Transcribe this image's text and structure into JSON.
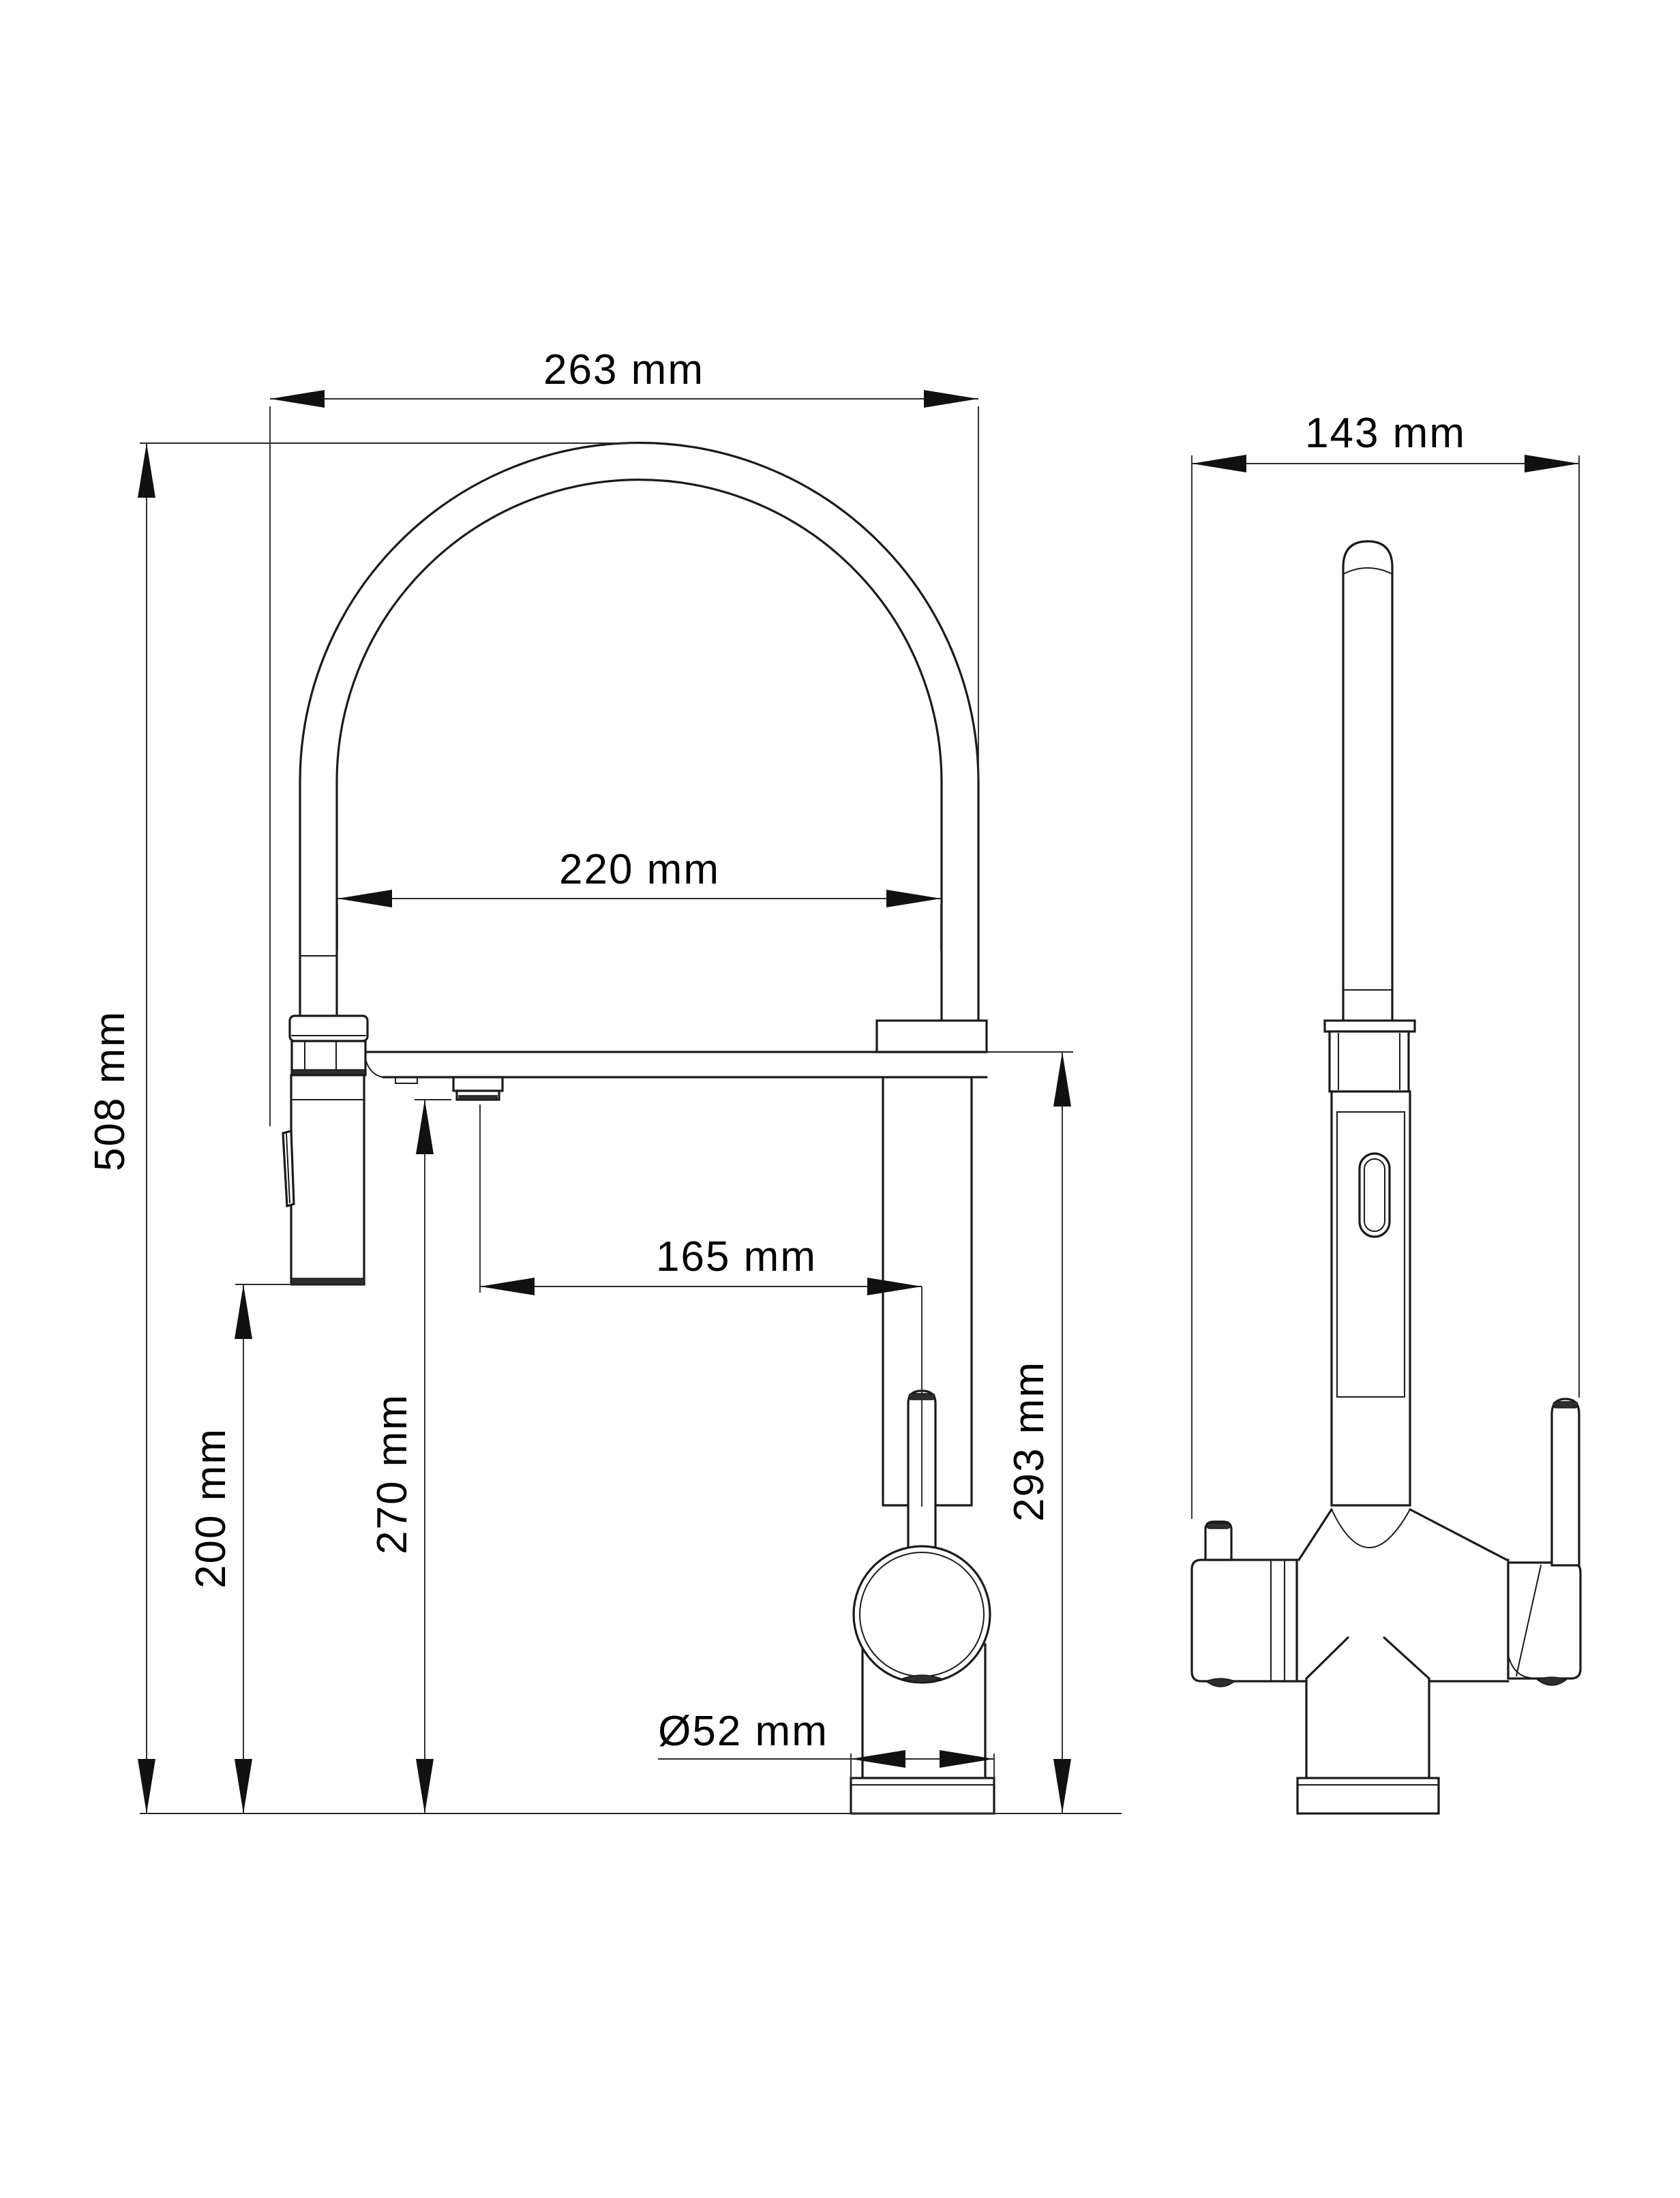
{
  "drawing": {
    "kind": "faucet-dimension-drawing",
    "background": "#ffffff",
    "line_color": "#1a1a1a",
    "views": {
      "front": {
        "name": "front view",
        "parts": [
          "hose-arc",
          "spray-head",
          "spout-arm",
          "aerator",
          "mixer-column",
          "lever-handle",
          "handle-ball",
          "base-plate"
        ]
      },
      "side": {
        "name": "side view",
        "parts": [
          "spray-hose",
          "collar-nut",
          "body-slot",
          "left-valve-block",
          "right-valve-block",
          "side-lever",
          "base-plate"
        ]
      }
    },
    "dimensions": {
      "overall_width_front": {
        "label": "263 mm",
        "value": 263,
        "unit": "mm",
        "orientation": "horizontal",
        "measures": "overall spout arc width"
      },
      "hose_inner_width": {
        "label": "220 mm",
        "value": 220,
        "unit": "mm",
        "orientation": "horizontal",
        "measures": "inner arc width"
      },
      "overall_height": {
        "label": "508 mm",
        "value": 508,
        "unit": "mm",
        "orientation": "vertical",
        "measures": "total height"
      },
      "spray_head_clearance": {
        "label": "200 mm",
        "value": 200,
        "unit": "mm",
        "orientation": "vertical",
        "measures": "spray head to counter"
      },
      "outlet_height": {
        "label": "270 mm",
        "value": 270,
        "unit": "mm",
        "orientation": "vertical",
        "measures": "aerator outlet to counter"
      },
      "spout_reach": {
        "label": "165 mm",
        "value": 165,
        "unit": "mm",
        "orientation": "horizontal",
        "measures": "outlet to column axis"
      },
      "spout_height": {
        "label": "293 mm",
        "value": 293,
        "unit": "mm",
        "orientation": "vertical",
        "measures": "spout arm to counter"
      },
      "base_diameter": {
        "label": "Ø52 mm",
        "value": 52,
        "unit": "mm",
        "orientation": "horizontal",
        "measures": "base diameter"
      },
      "overall_depth_side": {
        "label": "143 mm",
        "value": 143,
        "unit": "mm",
        "orientation": "horizontal",
        "measures": "overall depth, side view"
      }
    }
  }
}
